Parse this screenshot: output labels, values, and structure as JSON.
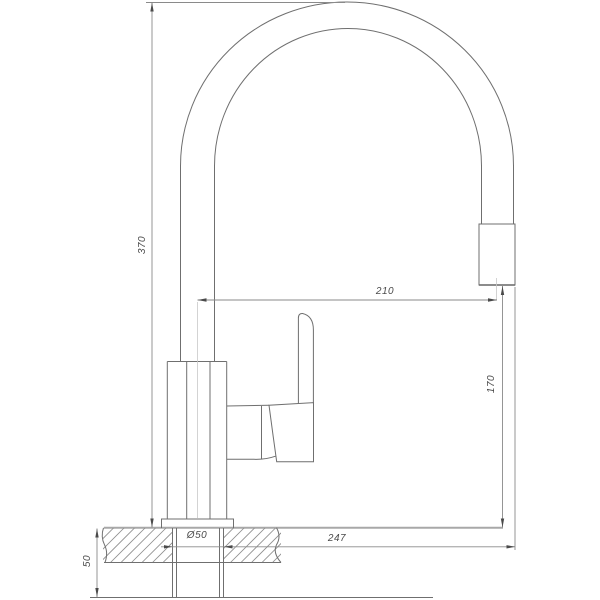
{
  "colors": {
    "background": "#ffffff",
    "outline": "#6f6f6f",
    "thick_line": "#a2a2a2",
    "dimension_line": "#8a8a8a",
    "text": "#4a4a4a"
  },
  "labels": {
    "height_overall": "370",
    "spout_reach": "210",
    "spout_height": "170",
    "mounting_hole_diameter": "Ø50",
    "reach_overall": "247",
    "under_counter_depth": "50"
  }
}
